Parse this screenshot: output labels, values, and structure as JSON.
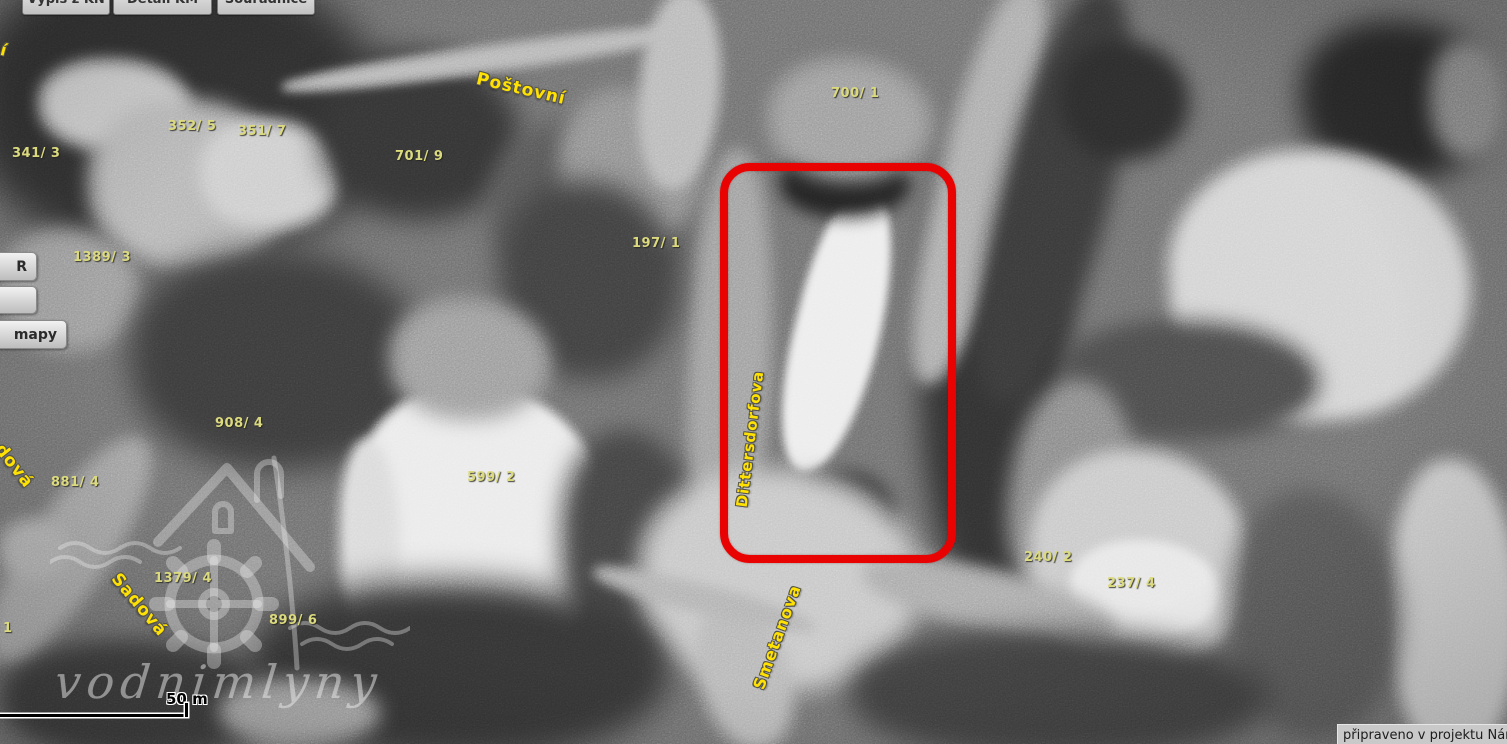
{
  "toolbar": {
    "buttons": [
      {
        "label": "Výpis z KN",
        "x": 22,
        "w": 86
      },
      {
        "label": "Detail KM",
        "x": 113,
        "w": 97
      },
      {
        "label": "Souřadnice",
        "x": 217,
        "w": 96
      }
    ]
  },
  "side_buttons": [
    {
      "label": "R",
      "y": 252,
      "w": 36,
      "h": 27
    },
    {
      "label": "",
      "y": 286,
      "w": 36,
      "h": 26
    },
    {
      "label": "mapy",
      "y": 320,
      "w": 66,
      "h": 27
    }
  ],
  "map": {
    "parcel_labels": [
      {
        "text": "352/ 5",
        "x": 168,
        "y": 119
      },
      {
        "text": "351/ 7",
        "x": 238,
        "y": 124
      },
      {
        "text": "341/ 3",
        "x": 12,
        "y": 146
      },
      {
        "text": "701/ 9",
        "x": 395,
        "y": 149
      },
      {
        "text": "1389/ 3",
        "x": 73,
        "y": 250
      },
      {
        "text": "197/ 1",
        "x": 632,
        "y": 236
      },
      {
        "text": "700/ 1",
        "x": 831,
        "y": 86
      },
      {
        "text": "908/ 4",
        "x": 215,
        "y": 416
      },
      {
        "text": "881/ 4",
        "x": 51,
        "y": 475
      },
      {
        "text": "599/ 2",
        "x": 467,
        "y": 470
      },
      {
        "text": "1379/ 4",
        "x": 154,
        "y": 571
      },
      {
        "text": "899/ 6",
        "x": 269,
        "y": 613
      },
      {
        "text": "240/ 2",
        "x": 1024,
        "y": 550
      },
      {
        "text": "237/ 4",
        "x": 1107,
        "y": 576
      },
      {
        "text": "1",
        "x": 3,
        "y": 621
      }
    ],
    "street_labels": [
      {
        "text": "Poštovní",
        "cx": 521,
        "cy": 89,
        "angle": 13,
        "size": 17
      },
      {
        "text": "Dittersdorfova",
        "cx": 750,
        "cy": 439,
        "angle": -83,
        "size": 15
      },
      {
        "text": "Smetanova",
        "cx": 777,
        "cy": 637,
        "angle": -70,
        "size": 16
      },
      {
        "text": "Sadová",
        "cx": 139,
        "cy": 605,
        "angle": 50,
        "size": 17
      },
      {
        "text": "dová",
        "cx": 14,
        "cy": 466,
        "angle": 52,
        "size": 17
      },
      {
        "text": "í",
        "cx": 4,
        "cy": 50,
        "angle": 15,
        "size": 16
      }
    ],
    "highlight": {
      "x": 720,
      "y": 163,
      "w": 220,
      "h": 384,
      "color": "#e80202"
    },
    "scale_bar": {
      "label": "50 m"
    },
    "watermark_text": "vodnimlyny"
  },
  "status_bar": {
    "text": "připraveno v projektu Národn"
  }
}
